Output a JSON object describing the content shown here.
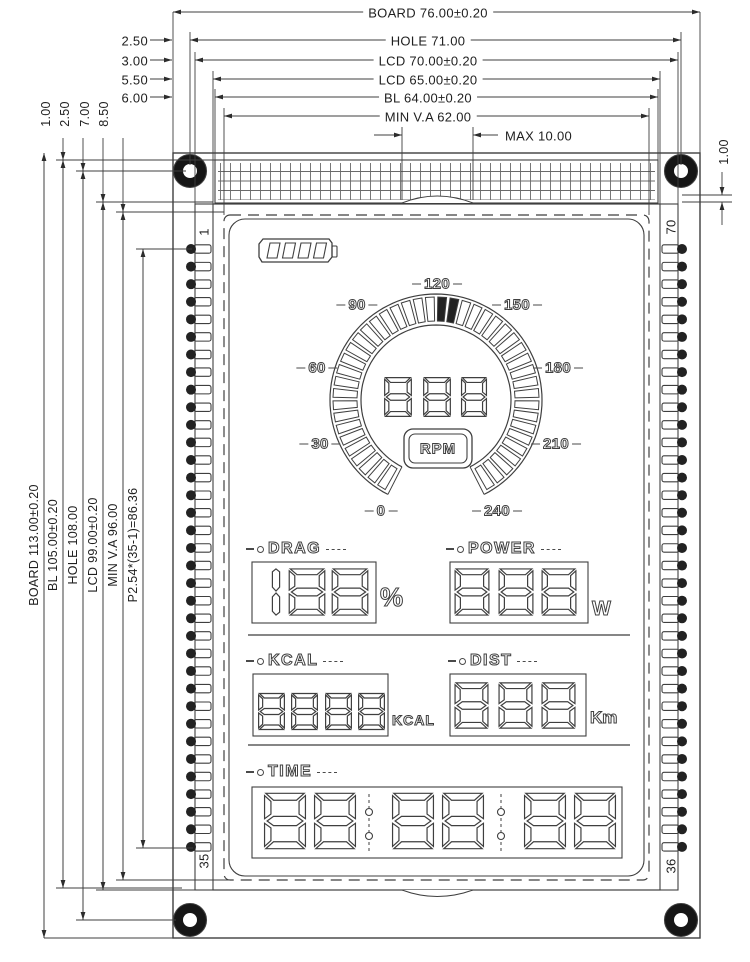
{
  "drawing": {
    "top_dimensions": [
      "BOARD 76.00±0.20",
      "HOLE 71.00",
      "LCD 70.00±0.20",
      "LCD 65.00±0.20",
      "BL 64.00±0.20",
      "MIN V.A 62.00",
      "MAX 10.00"
    ],
    "left_dimensions": [
      "BOARD 113.00±0.20",
      "BL 105.00±0.20",
      "HOLE 108.00",
      "LCD 99.00±0.20",
      "MIN V.A 96.00",
      "P2.54*(35-1)=86.36"
    ],
    "left_edge_offsets": [
      "2.50",
      "3.00",
      "5.50",
      "6.00"
    ],
    "top_edge_offsets": [
      "1.00",
      "2.50",
      "7.00",
      "8.50"
    ],
    "right_edge_offset": "1.00",
    "pin_numbers": {
      "top_left": "1",
      "bottom_left": "35",
      "top_right": "70",
      "bottom_right": "36"
    },
    "colors": {
      "ink": "#3f3f3f",
      "paper": "#ffffff",
      "hole": "#161616"
    }
  },
  "lcd": {
    "battery": {
      "icon": "battery-icon",
      "cells": 4
    },
    "gauge": {
      "scale_labels": [
        "0",
        "30",
        "60",
        "90",
        "120",
        "150",
        "180",
        "210",
        "240"
      ],
      "digits": "888",
      "unit": "RPM"
    },
    "drag": {
      "label": "DRAG",
      "digits": "188",
      "unit": "%"
    },
    "power": {
      "label": "POWER",
      "digits": "888",
      "unit": "W"
    },
    "kcal": {
      "label": "KCAL",
      "digits": "8888",
      "unit": "KCAL"
    },
    "dist": {
      "label": "DIST",
      "digits": "888",
      "unit": "Km"
    },
    "time": {
      "label": "TIME",
      "digits": "88:88:88",
      "unit": ""
    }
  }
}
